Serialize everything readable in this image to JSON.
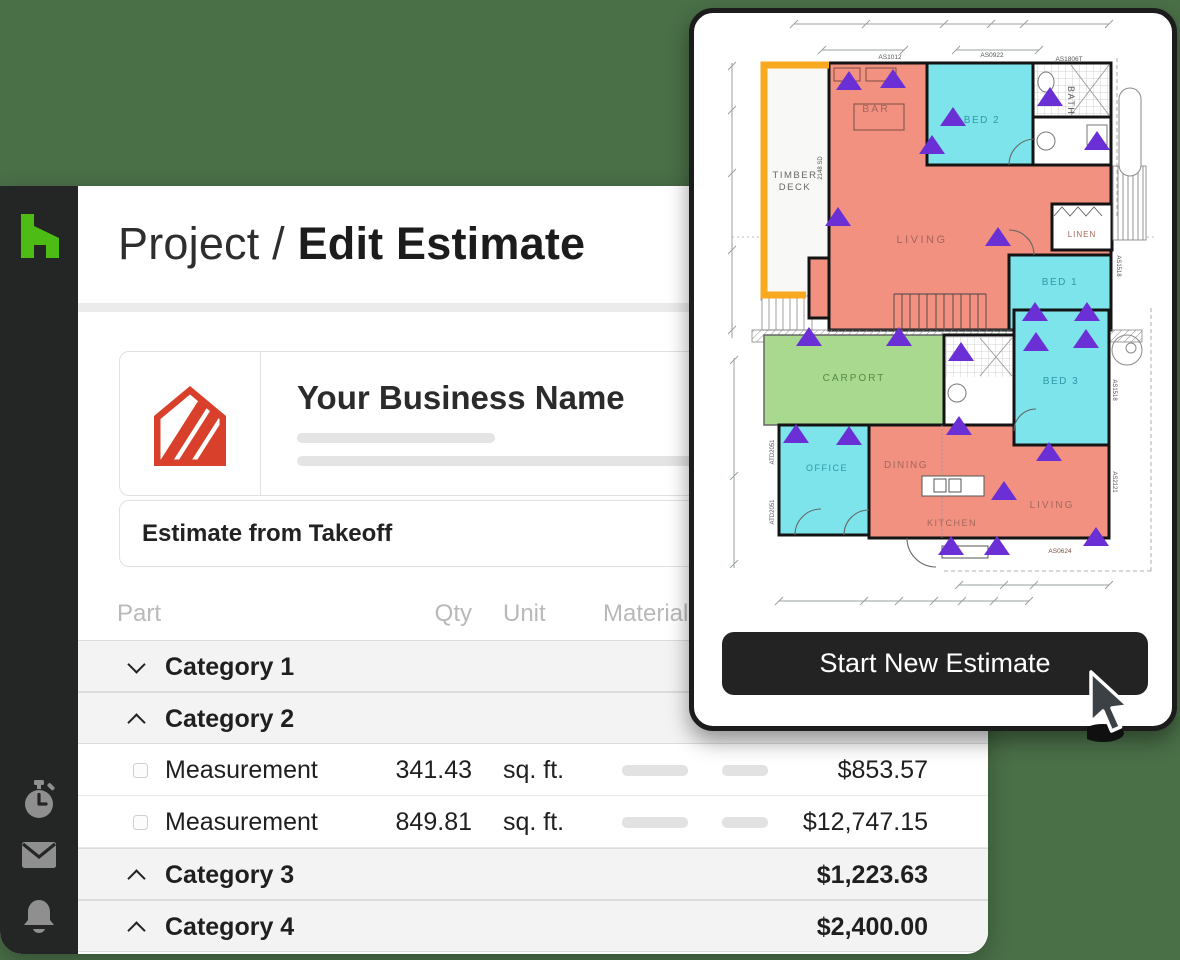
{
  "background_color": "#4A7048",
  "sidebar": {
    "logo_name": "houzz-logo",
    "icons": [
      "timer-icon",
      "mail-icon",
      "bell-icon"
    ]
  },
  "header": {
    "breadcrumb": "Project /",
    "title": "Edit Estimate"
  },
  "business_card": {
    "name": "Your Business Name"
  },
  "estimate_section": {
    "title": "Estimate from Takeoff"
  },
  "table": {
    "columns": [
      "Part",
      "Qty",
      "Unit",
      "Material"
    ],
    "rows": [
      {
        "type": "category",
        "chevron": "down",
        "label": "Category 1",
        "total": ""
      },
      {
        "type": "category",
        "chevron": "up",
        "label": "Category 2",
        "total": "$13,600.72"
      },
      {
        "type": "measurement",
        "label": "Measurement",
        "qty": "341.43",
        "unit": "sq. ft.",
        "total": "$853.57"
      },
      {
        "type": "measurement",
        "label": "Measurement",
        "qty": "849.81",
        "unit": "sq. ft.",
        "total": "$12,747.15"
      },
      {
        "type": "category",
        "chevron": "up",
        "label": "Category 3",
        "total": "$1,223.63"
      },
      {
        "type": "category",
        "chevron": "up",
        "label": "Category 4",
        "total": "$2,400.00"
      }
    ]
  },
  "overlay": {
    "button_label": "Start New Estimate"
  },
  "floorplan": {
    "rooms": [
      "TIMBER",
      "DECK",
      "BAR",
      "BED 2",
      "BATH",
      "LIVING",
      "LINEN",
      "BED 1",
      "CARPORT",
      "BED 3",
      "OFFICE",
      "DINING",
      "KITCHEN",
      "LIVING"
    ],
    "codes": [
      "AS1012",
      "AS0922",
      "AS1806T",
      "2148 SD",
      "AS1518",
      "AS1518",
      "AS2121",
      "ATD2051",
      "ATD2051",
      "AS0624"
    ],
    "colors": {
      "living": "#F29180",
      "bedroom": "#7CE4EA",
      "carport": "#A8D98F",
      "marker_purple": "#6B2FD6",
      "highlight_orange": "#F9A91F"
    }
  }
}
